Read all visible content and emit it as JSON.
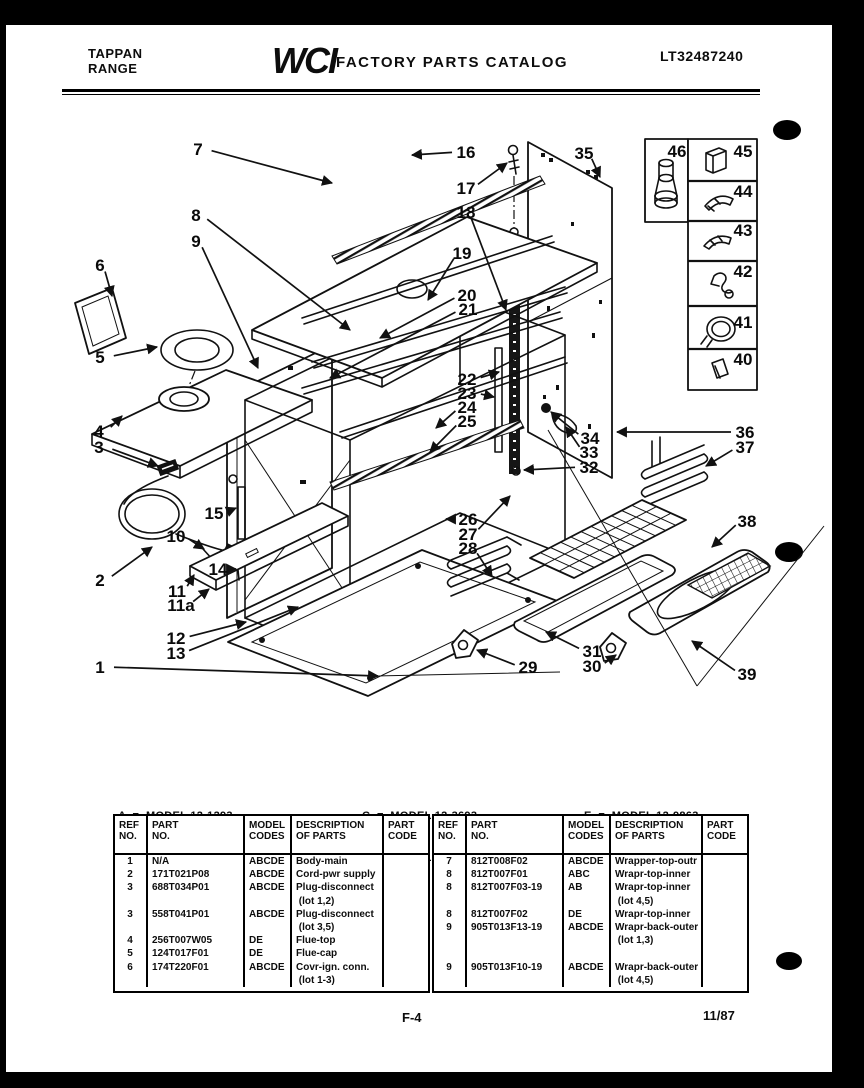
{
  "colors": {
    "ink": "#0d0d0d",
    "paper": "#ffffff",
    "band": "#000000"
  },
  "header": {
    "brand_line1": "TAPPAN",
    "brand_line2": "RANGE",
    "logo": "WCI",
    "title": "FACTORY PARTS CATALOG",
    "doc_number": "LT32487240"
  },
  "model_legend": {
    "items": [
      "A  =  MODEL 12-1293",
      "B  =  MODEL 12-1663",
      "C  =  MODEL 12-3693",
      "D  =  MODEL 12-6263",
      "E  =  MODEL 12-9863"
    ]
  },
  "parts_tables": {
    "headers": [
      "REF\nNO.",
      "PART\nNO.",
      "MODEL\nCODES",
      "DESCRIPTION\nOF PARTS",
      "PART\nCODE"
    ],
    "left": {
      "rows": [
        {
          "ref": "1",
          "part": "N/A",
          "codes": "ABCDE",
          "desc": "Body-main"
        },
        {
          "ref": "2",
          "part": "171T021P08",
          "codes": "ABCDE",
          "desc": "Cord-pwr supply"
        },
        {
          "ref": "3",
          "part": "688T034P01",
          "codes": "ABCDE",
          "desc": "Plug-disconnect"
        },
        {
          "ref": "",
          "part": "",
          "codes": "",
          "desc": " (lot 1,2)"
        },
        {
          "ref": "3",
          "part": "558T041P01",
          "codes": "ABCDE",
          "desc": "Plug-disconnect"
        },
        {
          "ref": "",
          "part": "",
          "codes": "",
          "desc": " (lot 3,5)"
        },
        {
          "ref": "4",
          "part": "256T007W05",
          "codes": "DE",
          "desc": "Flue-top"
        },
        {
          "ref": "5",
          "part": "124T017F01",
          "codes": "DE",
          "desc": "Flue-cap"
        },
        {
          "ref": "6",
          "part": "174T220F01",
          "codes": "ABCDE",
          "desc": "Covr-ign. conn."
        },
        {
          "ref": "",
          "part": "",
          "codes": "",
          "desc": " (lot 1-3)"
        }
      ]
    },
    "right": {
      "rows": [
        {
          "ref": "7",
          "part": "812T008F02",
          "codes": "ABCDE",
          "desc": "Wrapper-top-outr"
        },
        {
          "ref": "8",
          "part": "812T007F01",
          "codes": "ABC",
          "desc": "Wrapr-top-inner"
        },
        {
          "ref": "8",
          "part": "812T007F03-19",
          "codes": "AB",
          "desc": "Wrapr-top-inner"
        },
        {
          "ref": "",
          "part": "",
          "codes": "",
          "desc": " (lot 4,5)"
        },
        {
          "ref": "8",
          "part": "812T007F02",
          "codes": "DE",
          "desc": "Wrapr-top-inner"
        },
        {
          "ref": "9",
          "part": "905T013F13-19",
          "codes": "ABCDE",
          "desc": "Wrapr-back-outer"
        },
        {
          "ref": "",
          "part": "",
          "codes": "",
          "desc": " (lot 1,3)"
        },
        {
          "ref": "",
          "part": "",
          "codes": "",
          "desc": ""
        },
        {
          "ref": "9",
          "part": "905T013F10-19",
          "codes": "ABCDE",
          "desc": "Wrapr-back-outer"
        },
        {
          "ref": "",
          "part": "",
          "codes": "",
          "desc": " (lot 4,5)"
        }
      ]
    }
  },
  "footer": {
    "page_number": "F-4",
    "date": "11/87"
  },
  "diagram": {
    "callouts": [
      {
        "n": "7",
        "x": 198,
        "y": 149,
        "ex": 332,
        "ey": 183
      },
      {
        "n": "16",
        "x": 466,
        "y": 152,
        "ex": 412,
        "ey": 155
      },
      {
        "n": "17",
        "x": 466,
        "y": 188,
        "ex": 507,
        "ey": 163
      },
      {
        "n": "18",
        "x": 466,
        "y": 212,
        "ex": 506,
        "ey": 310
      },
      {
        "n": "35",
        "x": 584,
        "y": 153,
        "ex": 600,
        "ey": 177
      },
      {
        "n": "8",
        "x": 196,
        "y": 215,
        "ex": 350,
        "ey": 330
      },
      {
        "n": "9",
        "x": 196,
        "y": 241,
        "ex": 258,
        "ey": 368
      },
      {
        "n": "19",
        "x": 462,
        "y": 253,
        "ex": 428,
        "ey": 300
      },
      {
        "n": "20",
        "x": 467,
        "y": 295,
        "ex": 380,
        "ey": 338
      },
      {
        "n": "21",
        "x": 468,
        "y": 309,
        "ex": 330,
        "ey": 378
      },
      {
        "n": "6",
        "x": 100,
        "y": 265,
        "ex": 112,
        "ey": 296
      },
      {
        "n": "5",
        "x": 100,
        "y": 357,
        "ex": 157,
        "ey": 347
      },
      {
        "n": "22",
        "x": 467,
        "y": 379,
        "ex": 499,
        "ey": 372
      },
      {
        "n": "23",
        "x": 467,
        "y": 393,
        "ex": 494,
        "ey": 397
      },
      {
        "n": "24",
        "x": 467,
        "y": 407,
        "ex": 436,
        "ey": 428
      },
      {
        "n": "25",
        "x": 467,
        "y": 421,
        "ex": 430,
        "ey": 452
      },
      {
        "n": "4",
        "x": 99,
        "y": 431,
        "ex": 122,
        "ey": 416
      },
      {
        "n": "3",
        "x": 99,
        "y": 447,
        "ex": 158,
        "ey": 466
      },
      {
        "n": "34",
        "x": 590,
        "y": 438,
        "ex": 551,
        "ey": 412
      },
      {
        "n": "33",
        "x": 589,
        "y": 452,
        "ex": 566,
        "ey": 427
      },
      {
        "n": "32",
        "x": 589,
        "y": 467,
        "ex": 524,
        "ey": 470
      },
      {
        "n": "36",
        "x": 745,
        "y": 432,
        "ex": 617,
        "ey": 432
      },
      {
        "n": "37",
        "x": 745,
        "y": 447,
        "ex": 706,
        "ey": 466
      },
      {
        "n": "15",
        "x": 214,
        "y": 513,
        "ex": 236,
        "ey": 508
      },
      {
        "n": "26",
        "x": 468,
        "y": 519,
        "ex": 446,
        "ey": 519
      },
      {
        "n": "27",
        "x": 468,
        "y": 534,
        "ex": 510,
        "ey": 496
      },
      {
        "n": "28",
        "x": 468,
        "y": 548,
        "ex": 492,
        "ey": 576
      },
      {
        "n": "38",
        "x": 747,
        "y": 521,
        "ex": 712,
        "ey": 547
      },
      {
        "n": "10",
        "x": 176,
        "y": 536,
        "ex": 204,
        "ey": 549
      },
      {
        "n": "14",
        "x": 218,
        "y": 569,
        "ex": 236,
        "ey": 569
      },
      {
        "n": "2",
        "x": 100,
        "y": 580,
        "ex": 152,
        "ey": 547
      },
      {
        "n": "11",
        "x": 177,
        "y": 591,
        "ex": 194,
        "ey": 575
      },
      {
        "n": "11a",
        "x": 181,
        "y": 605,
        "ex": 209,
        "ey": 589
      },
      {
        "n": "12",
        "x": 176,
        "y": 638,
        "ex": 246,
        "ey": 622
      },
      {
        "n": "13",
        "x": 176,
        "y": 653,
        "ex": 298,
        "ey": 607
      },
      {
        "n": "1",
        "x": 100,
        "y": 667,
        "ex": 378,
        "ey": 676
      },
      {
        "n": "29",
        "x": 528,
        "y": 667,
        "ex": 477,
        "ey": 650
      },
      {
        "n": "31",
        "x": 592,
        "y": 651,
        "ex": 546,
        "ey": 632
      },
      {
        "n": "30",
        "x": 592,
        "y": 666,
        "ex": 616,
        "ey": 655
      },
      {
        "n": "39",
        "x": 747,
        "y": 674,
        "ex": 692,
        "ey": 641
      },
      {
        "n": "46",
        "x": 677,
        "y": 151
      },
      {
        "n": "45",
        "x": 743,
        "y": 151
      },
      {
        "n": "44",
        "x": 743,
        "y": 191
      },
      {
        "n": "43",
        "x": 743,
        "y": 230
      },
      {
        "n": "42",
        "x": 743,
        "y": 271
      },
      {
        "n": "41",
        "x": 743,
        "y": 322
      },
      {
        "n": "40",
        "x": 743,
        "y": 359
      }
    ]
  }
}
